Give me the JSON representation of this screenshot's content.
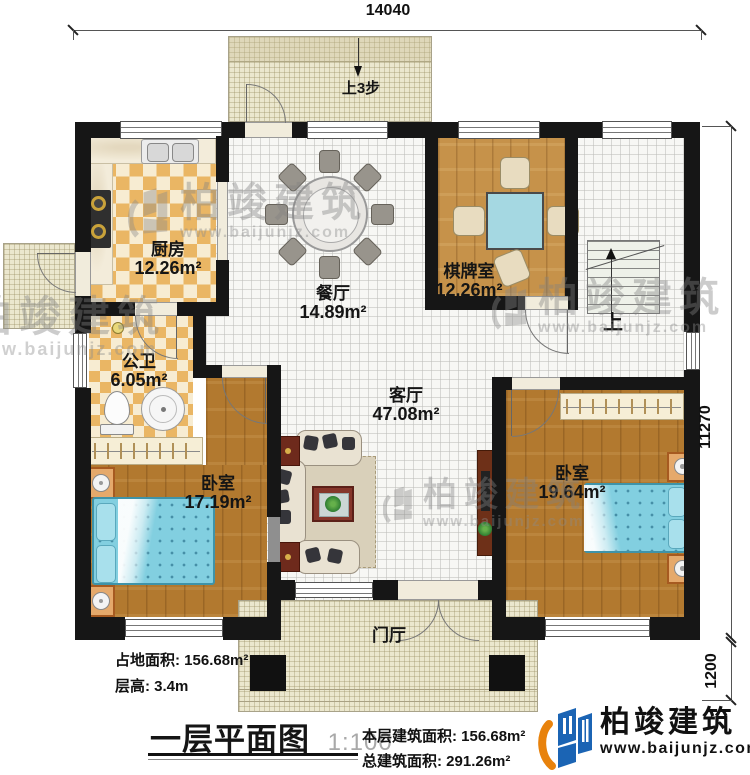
{
  "dimensions": {
    "top": "14040",
    "right": "11270",
    "bottom_right": "1200"
  },
  "annotations": {
    "entry_steps": "上3步",
    "stairs_up": "上",
    "foyer": "门厅"
  },
  "rooms": {
    "kitchen": {
      "name": "厨房",
      "area": "12.26m²"
    },
    "dining": {
      "name": "餐厅",
      "area": "14.89m²"
    },
    "chess": {
      "name": "棋牌室",
      "area": "12.26m²"
    },
    "bath": {
      "name": "公卫",
      "area": "6.05m²"
    },
    "living": {
      "name": "客厅",
      "area": "47.08m²"
    },
    "bedroom_left": {
      "name": "卧室",
      "area": "17.19m²"
    },
    "bedroom_right": {
      "name": "卧室",
      "area": "19.64m²"
    }
  },
  "footer": {
    "site_area_label": "占地面积:",
    "site_area_value": "156.68m²",
    "floor_height_label": "层高:",
    "floor_height_value": "3.4m",
    "plan_title": "一层平面图",
    "plan_scale": "1:100",
    "floor_area_label": "本层建筑面积:",
    "floor_area_value": "156.68m²",
    "total_area_label": "总建筑面积:",
    "total_area_value": "291.26m²"
  },
  "brand": {
    "name": "柏竣建筑",
    "website": "www.baijunjz.com"
  },
  "colors": {
    "wall": "#161616",
    "wood": "#b2792f",
    "wood_light": "#c6924a",
    "checker": "#eab664",
    "tile": "#f7f7f4",
    "hatch": "#ebe7ce",
    "bed": "#82cfe0",
    "chess_table": "#a5d8e2",
    "logo_blue": "#1b64b4",
    "logo_orange": "#e8820c",
    "watermark": "#8a8a8a"
  }
}
